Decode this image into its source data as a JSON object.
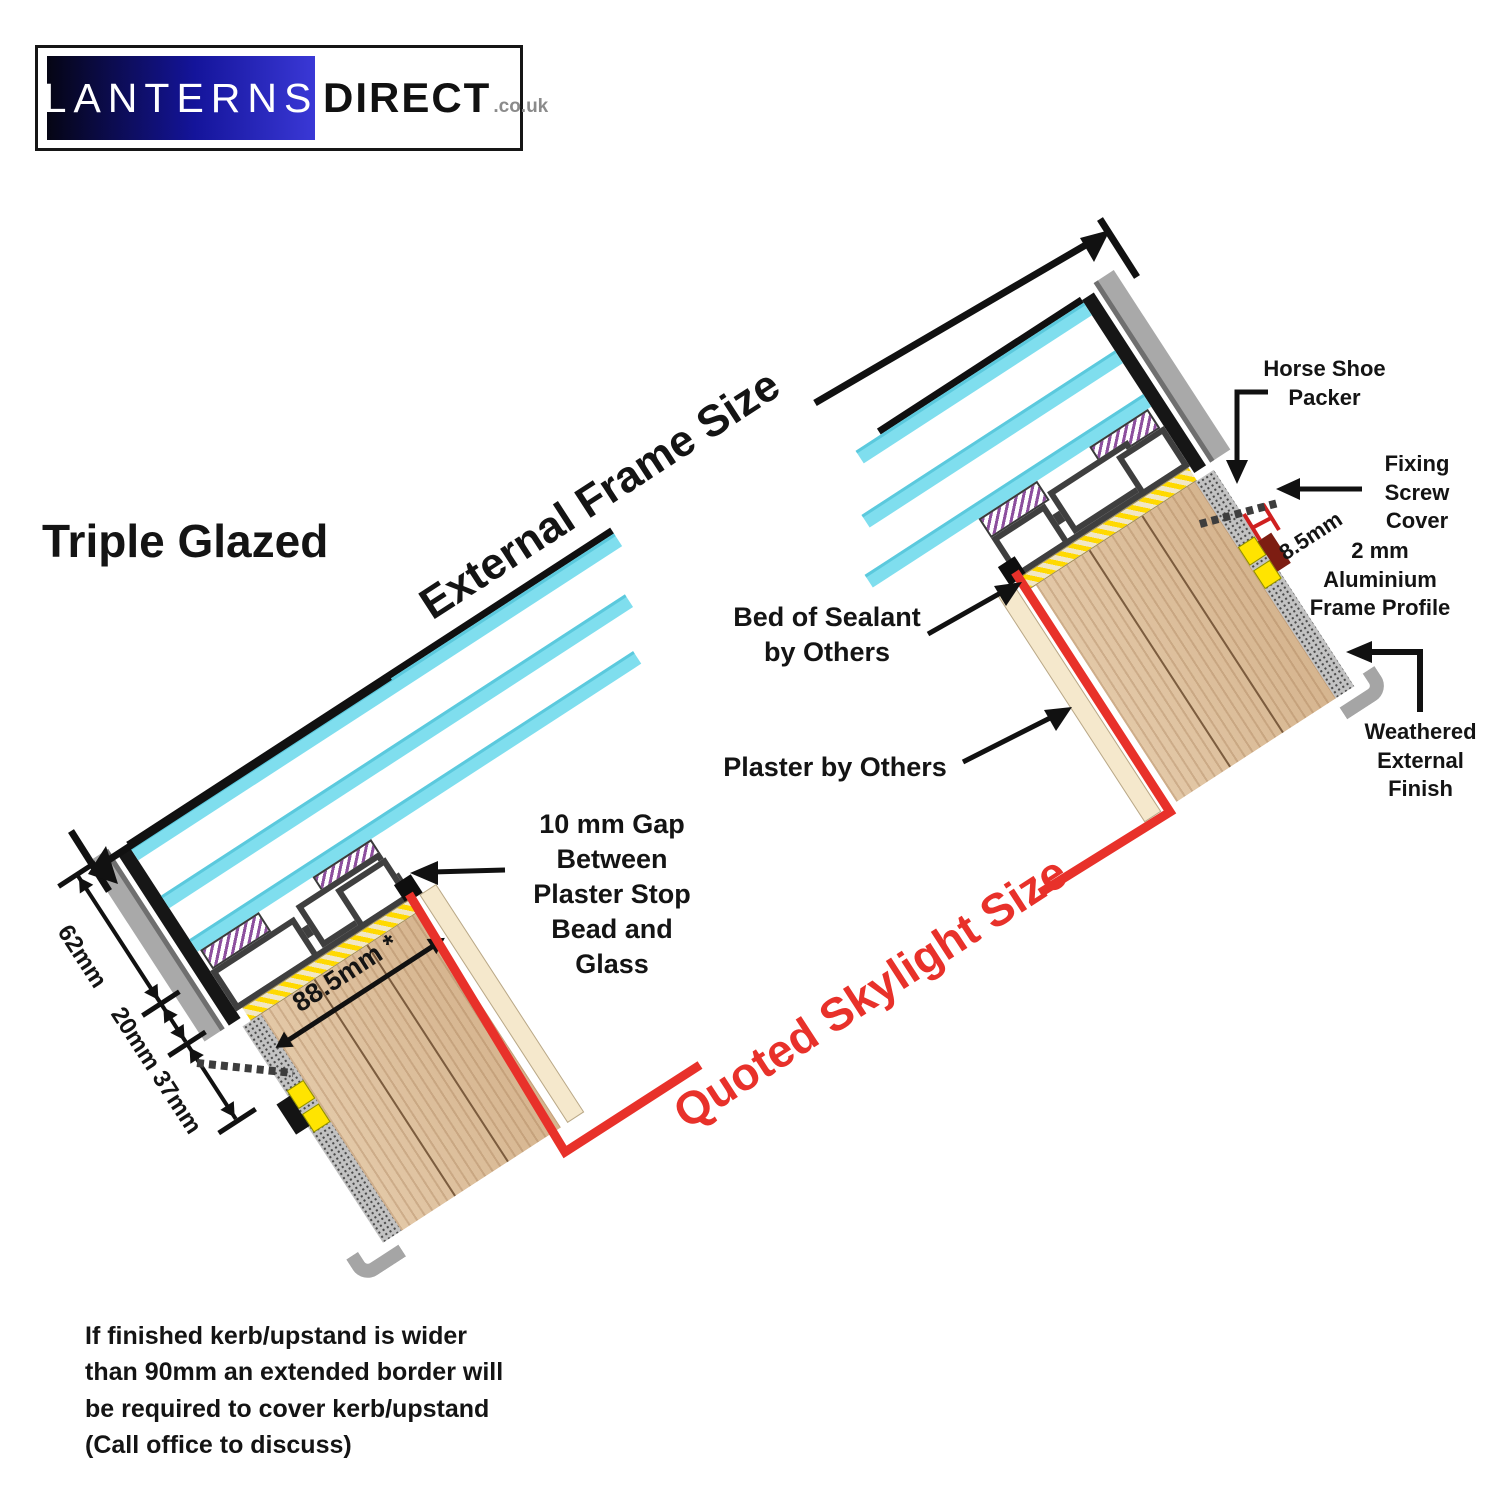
{
  "logo": {
    "brand_primary": "LANTERNS",
    "brand_secondary": "DIRECT",
    "brand_suffix": ".co.uk"
  },
  "heading": "Triple Glazed",
  "dimensions": {
    "external_frame_size": "External Frame Size",
    "quoted_skylight_size": "Quoted Skylight Size",
    "glass_unit_height": "62mm",
    "frame_height": "20mm",
    "fixing_zone_height": "37mm",
    "kerb_width": "88.5mm *",
    "profile_gap": "8.5mm"
  },
  "annotations": {
    "horse_shoe_packer": "Horse Shoe Packer",
    "fixing_screw_cover": "Fixing Screw Cover",
    "aluminium_frame_profile": "2 mm Aluminium Frame Profile",
    "bed_of_sealant": "Bed of Sealant by Others",
    "plaster_by_others": "Plaster by Others",
    "gap_note": "10 mm Gap Between Plaster Stop Bead and Glass",
    "weathered_external_finish": "Weathered External Finish"
  },
  "footnote": "If finished kerb/upstand is wider than 90mm an extended border will be required to cover kerb/upstand (Call office to discuss)",
  "colors": {
    "accent_red": "#e8312a",
    "glass_cyan": "#7fdeee",
    "capping_gray": "#a9a9a9",
    "frame_dark": "#3f3f3f",
    "kerb_wood": "#dcbd9b",
    "sealant_yellow": "#ffd900",
    "gasket_purple": "#8d4f9e",
    "packer_yellow": "#ffe400",
    "logo_blue": "#2d2fc4"
  }
}
